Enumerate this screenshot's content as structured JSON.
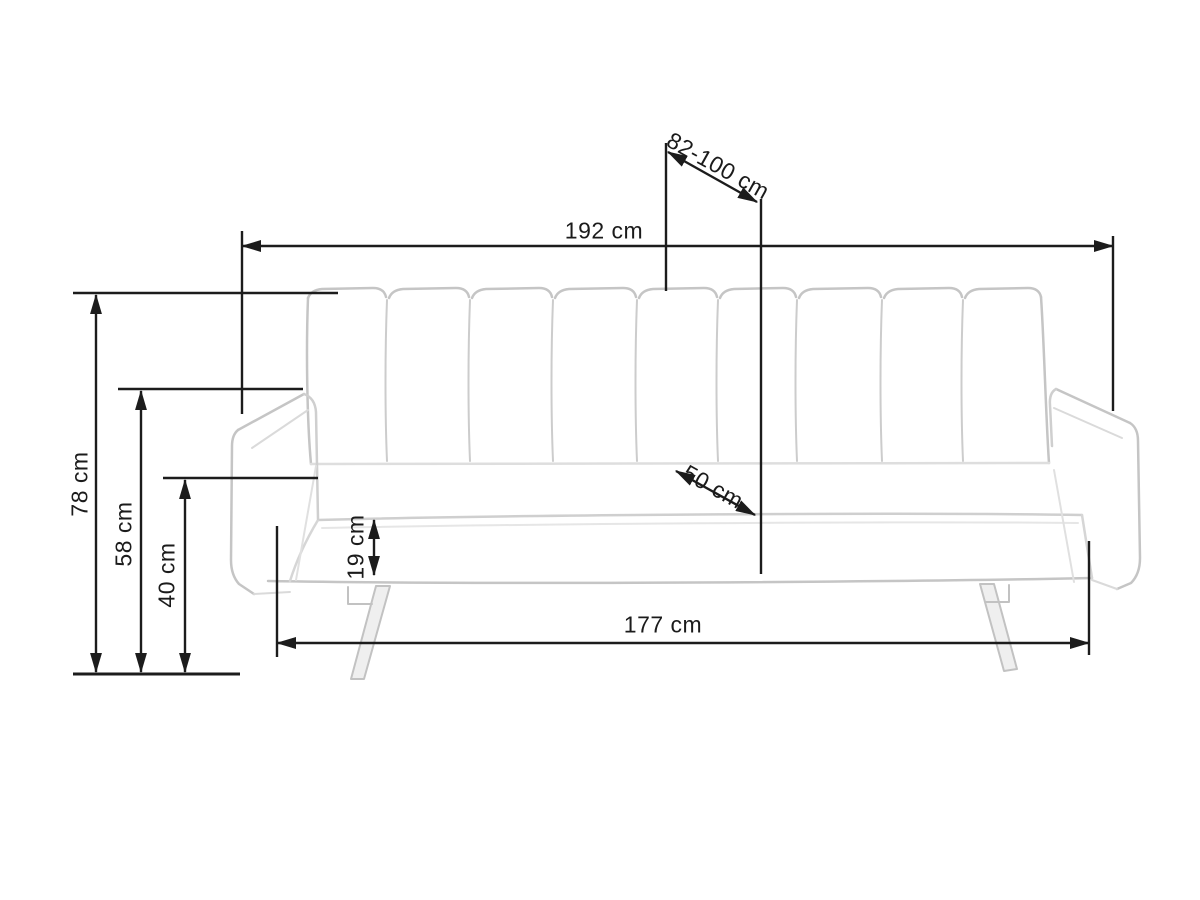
{
  "drawing": {
    "type": "sofa-bed dimensional technical drawing",
    "unit": "cm",
    "dimension_labels": {
      "overall_width": "192 cm",
      "depth_adjustable": "82-100 cm",
      "total_height": "78 cm",
      "armrest_height": "58 cm",
      "seat_height": "40 cm",
      "seat_cushion_thickness": "19 cm",
      "seat_depth": "50 cm",
      "base_width": "177 cm"
    },
    "colors": {
      "dimension_line": "#1c1c1c",
      "sofa_sketch_line": "#c5c5c5",
      "background": "#ffffff"
    }
  }
}
